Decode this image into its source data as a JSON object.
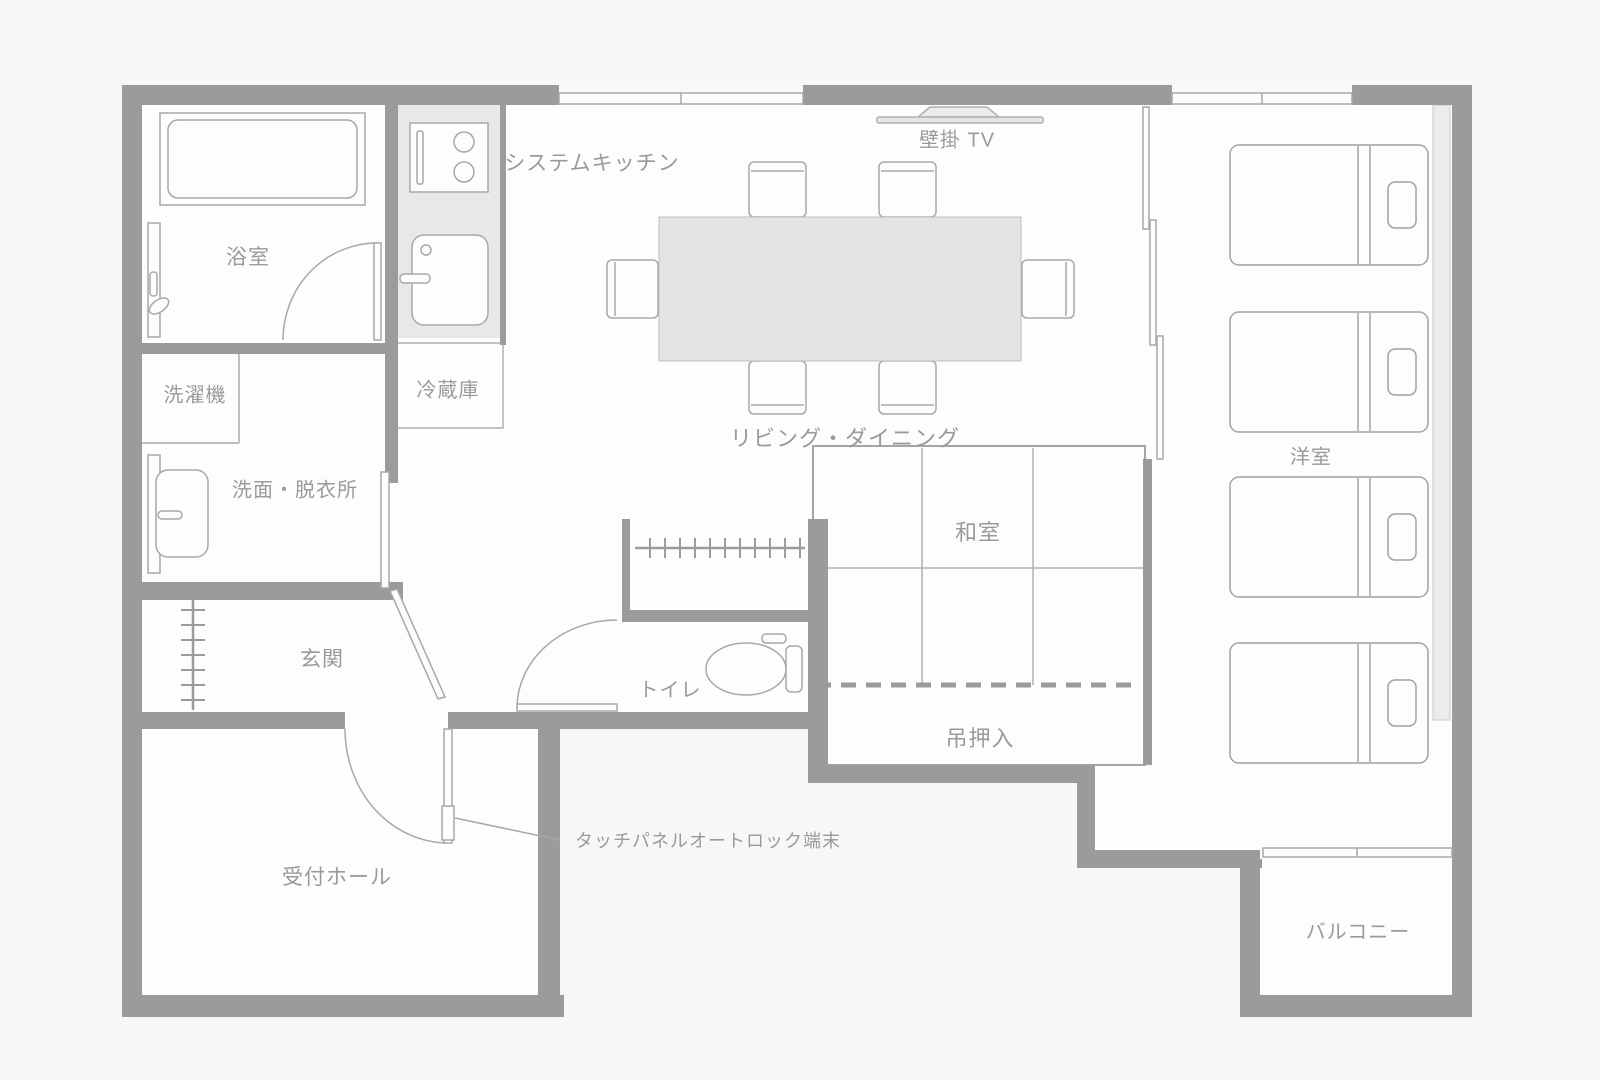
{
  "title": "間取り図",
  "colors": {
    "background": "#f7f7f7",
    "floor": "#fdfdfd",
    "wall": "#9b9b9b",
    "line": "#a8a8a8",
    "table_fill": "#e4e4e4",
    "counter_fill": "#e8e8e8",
    "duct_fill": "#ececec",
    "text": "#9a9a9a"
  },
  "rooms": [
    {
      "id": "bathroom",
      "label": "浴室",
      "x": 248,
      "y": 256,
      "size": 21
    },
    {
      "id": "washing-machine",
      "label": "洗濯機",
      "x": 195,
      "y": 393,
      "size": 20
    },
    {
      "id": "washroom",
      "label": "洗面・脱衣所",
      "x": 295,
      "y": 488,
      "size": 20
    },
    {
      "id": "genkan",
      "label": "玄関",
      "x": 322,
      "y": 658,
      "size": 21
    },
    {
      "id": "reception-hall",
      "label": "受付ホール",
      "x": 337,
      "y": 876,
      "size": 21
    },
    {
      "id": "system-kitchen",
      "label": "システムキッチン",
      "x": 592,
      "y": 162,
      "size": 21
    },
    {
      "id": "refrigerator",
      "label": "冷蔵庫",
      "x": 448,
      "y": 388,
      "size": 20
    },
    {
      "id": "living-dining",
      "label": "リビング・ダイニング",
      "x": 845,
      "y": 437,
      "size": 22
    },
    {
      "id": "wall-tv",
      "label": "壁掛 TV",
      "x": 957,
      "y": 138,
      "size": 20
    },
    {
      "id": "washitsu",
      "label": "和室",
      "x": 978,
      "y": 531,
      "size": 22
    },
    {
      "id": "hanging-closet",
      "label": "吊押入",
      "x": 980,
      "y": 737,
      "size": 22
    },
    {
      "id": "toilet",
      "label": "トイレ",
      "x": 670,
      "y": 688,
      "size": 20
    },
    {
      "id": "western-room",
      "label": "洋室",
      "x": 1311,
      "y": 455,
      "size": 20
    },
    {
      "id": "balcony",
      "label": "バルコニー",
      "x": 1358,
      "y": 930,
      "size": 20
    }
  ],
  "annotation": {
    "id": "autolock-terminal",
    "label": "タッチパネルオートロック端末",
    "x": 575,
    "y": 840,
    "size": 18,
    "anchor": "start"
  }
}
